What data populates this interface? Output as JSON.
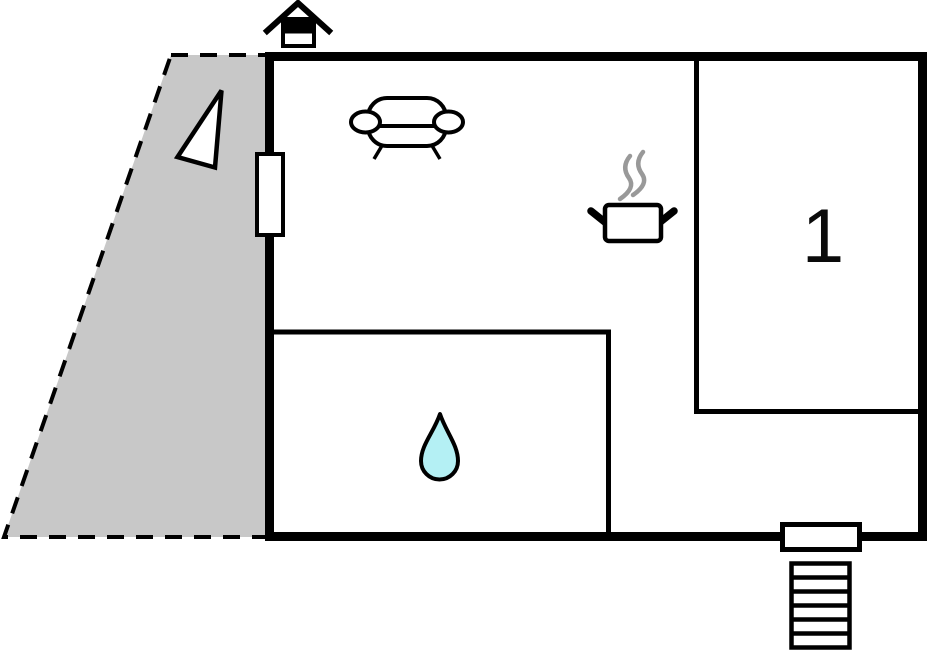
{
  "floorplan": {
    "room_label": "1",
    "colors": {
      "background": "#ffffff",
      "wall": "#000000",
      "terrace_fill": "#c8c8c8",
      "water_drop_fill": "#b4f0f4",
      "steam_stroke": "#999999"
    },
    "icons": {
      "entrance_marker": "house-entrance-icon",
      "orientation": "north-arrow-icon",
      "living_area": "sofa-icon",
      "kitchen": "cooking-pot-icon",
      "bathroom": "water-drop-icon",
      "window": "window",
      "door": "entrance-door",
      "stairs": "stairs-icon",
      "terrace": "terrace-area"
    }
  }
}
